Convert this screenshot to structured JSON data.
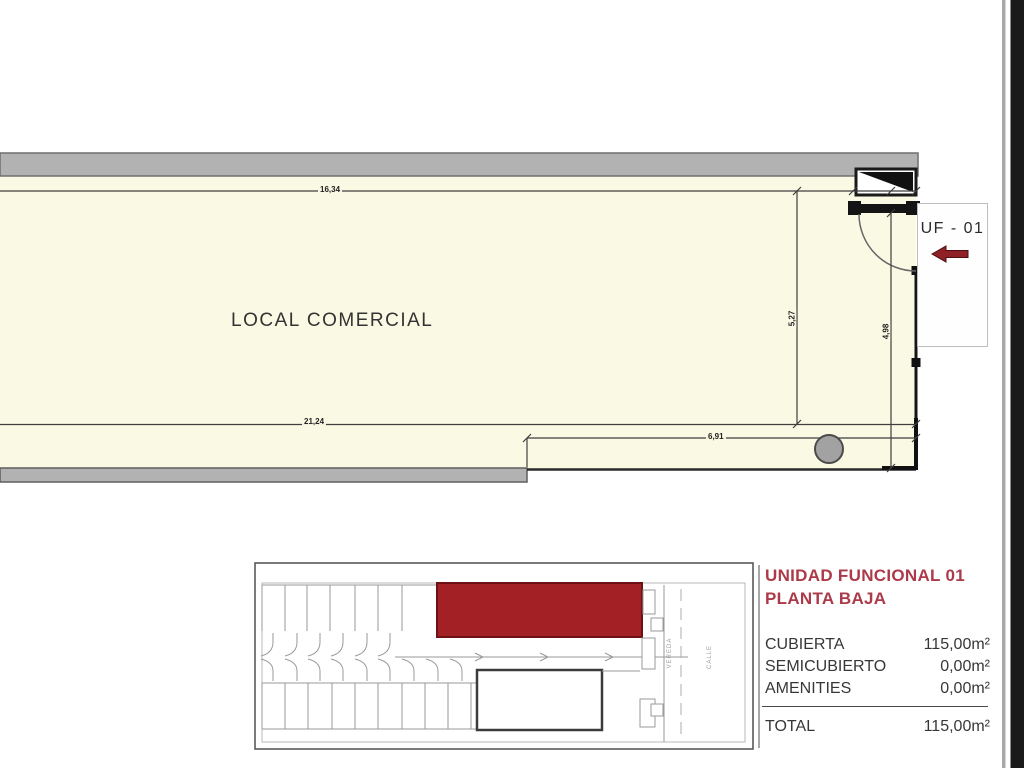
{
  "plan": {
    "room_label": "LOCAL COMERCIAL",
    "unit_tag": "UF - 01",
    "dimensions": {
      "top_width": "16,34",
      "bottom_width_left": "21,24",
      "bottom_width_right": "6,91",
      "height_left": "5,27",
      "height_right": "4,98"
    }
  },
  "key_plan": {
    "street_label_1": "VEREDA",
    "street_label_2": "CALLE",
    "highlight_color": "#a32125"
  },
  "legend": {
    "title_line1": "UNIDAD FUNCIONAL 01",
    "title_line2": "PLANTA BAJA",
    "title_color": "#ad3a49",
    "rows": [
      {
        "label": "CUBIERTA",
        "value": "115,00m²"
      },
      {
        "label": "SEMICUBIERTO",
        "value": "0,00m²"
      },
      {
        "label": "AMENITIES",
        "value": "0,00m²"
      }
    ],
    "total_label": "TOTAL",
    "total_value": "115,00m²"
  },
  "colors": {
    "floor_fill": "#fafae4",
    "wall_gray": "#b2b2b2",
    "accent_red": "#8f2025"
  }
}
